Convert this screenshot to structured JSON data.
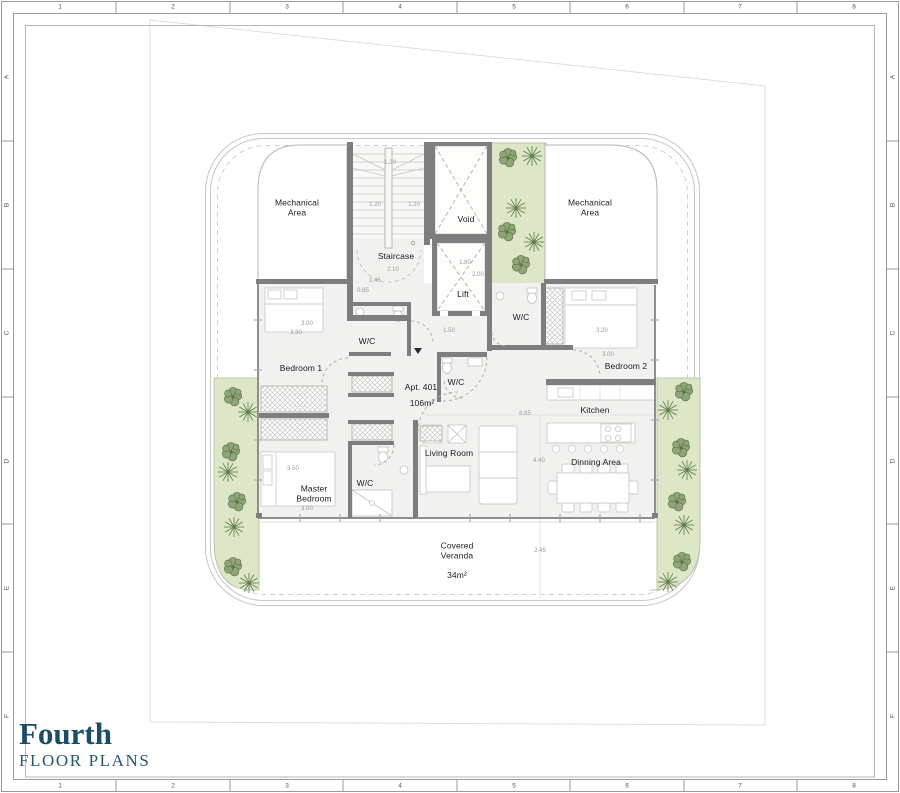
{
  "title_block": {
    "title": "Fourth",
    "subtitle": "FLOOR PLANS"
  },
  "frame": {
    "top_numbers": [
      {
        "t": "1",
        "x": 60
      },
      {
        "t": "2",
        "x": 173
      },
      {
        "t": "3",
        "x": 287
      },
      {
        "t": "4",
        "x": 400
      },
      {
        "t": "5",
        "x": 514
      },
      {
        "t": "6",
        "x": 627
      },
      {
        "t": "7",
        "x": 740
      },
      {
        "t": "8",
        "x": 854
      }
    ],
    "bottom_numbers": [
      {
        "t": "1",
        "x": 60
      },
      {
        "t": "2",
        "x": 173
      },
      {
        "t": "3",
        "x": 287
      },
      {
        "t": "4",
        "x": 400
      },
      {
        "t": "5",
        "x": 514
      },
      {
        "t": "6",
        "x": 627
      },
      {
        "t": "7",
        "x": 740
      },
      {
        "t": "8",
        "x": 854
      }
    ],
    "left_letters": [
      {
        "t": "A",
        "y": 77
      },
      {
        "t": "B",
        "y": 205
      },
      {
        "t": "C",
        "y": 333
      },
      {
        "t": "D",
        "y": 461
      },
      {
        "t": "E",
        "y": 588
      },
      {
        "t": "F",
        "y": 716
      }
    ],
    "right_letters": [
      {
        "t": "A",
        "y": 77
      },
      {
        "t": "B",
        "y": 205
      },
      {
        "t": "C",
        "y": 333
      },
      {
        "t": "D",
        "y": 461
      },
      {
        "t": "E",
        "y": 588
      },
      {
        "t": "F",
        "y": 716
      }
    ]
  },
  "plan": {
    "room_labels": [
      {
        "id": "mechanical-area-left",
        "lines": [
          "Mechanical",
          "Area"
        ],
        "x": 297,
        "y": 208
      },
      {
        "id": "mechanical-area-right",
        "lines": [
          "Mechanical",
          "Area"
        ],
        "x": 590,
        "y": 208
      },
      {
        "id": "void",
        "lines": [
          "Void"
        ],
        "x": 466,
        "y": 220
      },
      {
        "id": "staircase",
        "lines": [
          "Staircase"
        ],
        "x": 396,
        "y": 257
      },
      {
        "id": "lift",
        "lines": [
          "Lift"
        ],
        "x": 463,
        "y": 295
      },
      {
        "id": "wc-bedroom1",
        "lines": [
          "W/C"
        ],
        "x": 367,
        "y": 342
      },
      {
        "id": "wc-bedroom2",
        "lines": [
          "W/C"
        ],
        "x": 521,
        "y": 318
      },
      {
        "id": "wc-guest",
        "lines": [
          "W/C"
        ],
        "x": 456,
        "y": 383
      },
      {
        "id": "wc-master",
        "lines": [
          "W/C"
        ],
        "x": 365,
        "y": 484
      },
      {
        "id": "bedroom-1",
        "lines": [
          "Bedroom 1"
        ],
        "x": 301,
        "y": 369
      },
      {
        "id": "bedroom-2",
        "lines": [
          "Bedroom 2"
        ],
        "x": 626,
        "y": 367
      },
      {
        "id": "master-bedroom",
        "lines": [
          "Master",
          "Bedroom"
        ],
        "x": 314,
        "y": 494
      },
      {
        "id": "kitchen",
        "lines": [
          "Kitchen"
        ],
        "x": 595,
        "y": 411
      },
      {
        "id": "living-room",
        "lines": [
          "Living Room"
        ],
        "x": 449,
        "y": 454
      },
      {
        "id": "dinning-area",
        "lines": [
          "Dinning Area"
        ],
        "x": 596,
        "y": 463
      },
      {
        "id": "apt-number",
        "lines": [
          "Apt. 401"
        ],
        "x": 421,
        "y": 388
      },
      {
        "id": "apt-area",
        "lines": [
          "106m²"
        ],
        "x": 422,
        "y": 404
      },
      {
        "id": "covered-veranda",
        "lines": [
          "Covered",
          "Veranda"
        ],
        "x": 457,
        "y": 551
      },
      {
        "id": "veranda-area",
        "lines": [
          "34m²"
        ],
        "x": 457,
        "y": 576
      }
    ],
    "dimensions": [
      {
        "t": "1.20",
        "x": 390,
        "y": 163
      },
      {
        "t": "1.20",
        "x": 375,
        "y": 205
      },
      {
        "t": "1.20",
        "x": 414,
        "y": 205
      },
      {
        "t": "2.10",
        "x": 393,
        "y": 270
      },
      {
        "t": "1.45",
        "x": 375,
        "y": 281
      },
      {
        "t": "0.85",
        "x": 363,
        "y": 291
      },
      {
        "t": "1.80",
        "x": 465,
        "y": 263
      },
      {
        "t": "2.00",
        "x": 478,
        "y": 275
      },
      {
        "t": "1.50",
        "x": 449,
        "y": 331
      },
      {
        "t": "3.00",
        "x": 307,
        "y": 324
      },
      {
        "t": "3.30",
        "x": 296,
        "y": 333
      },
      {
        "t": "3.20",
        "x": 602,
        "y": 331
      },
      {
        "t": "3.00",
        "x": 608,
        "y": 355
      },
      {
        "t": "8.85",
        "x": 525,
        "y": 414
      },
      {
        "t": "4.40",
        "x": 539,
        "y": 461
      },
      {
        "t": "3.50",
        "x": 293,
        "y": 469
      },
      {
        "t": "3.00",
        "x": 307,
        "y": 509
      },
      {
        "t": "2.45",
        "x": 540,
        "y": 551
      }
    ],
    "colors": {
      "green_area": "#dde7c8",
      "wall": "#7e7e7e",
      "floor": "#f1f1ef",
      "title_accent": "#1d4d63",
      "tree": "#5a7244"
    }
  }
}
